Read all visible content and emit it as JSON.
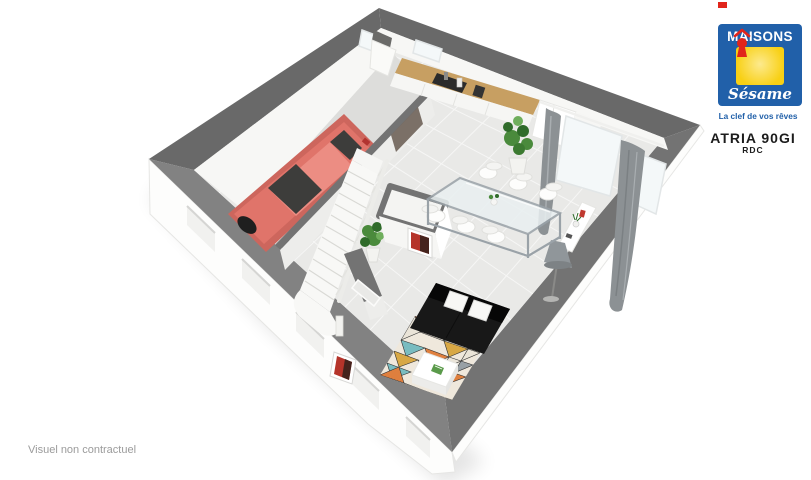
{
  "branding": {
    "maisons": "MAISONS",
    "sesame": "Sésame",
    "tagline": "La clef de vos rêves"
  },
  "plan": {
    "model": "ATRIA 90GI",
    "level": "RDC"
  },
  "footer": {
    "disclaimer": "Visuel non contractuel"
  },
  "scene": {
    "type": "3d-isometric-floor-plan",
    "elements": [
      "garage",
      "red-car",
      "staircase",
      "kitchen-counter",
      "extractor-hood",
      "tall-cabinets",
      "dining-table",
      "white-chairs",
      "bay-window",
      "gray-curtains",
      "console",
      "floor-lamp",
      "black-sofa",
      "white-pillows",
      "mosaic-rug",
      "coffee-table",
      "plants",
      "wc-block",
      "red-artwork",
      "entry-door",
      "exterior-walls"
    ]
  },
  "colors": {
    "paper": "#ffffff",
    "brandBlue": "#2160a9",
    "brandYellow": "#f8d014",
    "brandRed": "#e1251b",
    "text": "#1c1c1c",
    "disclaimer": "#9b9b9b",
    "wallTop": "#737373",
    "wallTopDark": "#696969",
    "wallTopLight": "#828282",
    "wallFace": "#f7f7f5",
    "floorTile": "#e9e9e7",
    "garageFloor": "#dddddb",
    "car": "#e0746a",
    "carDark": "#cd665d",
    "glassDark": "#3d3d3b",
    "sofa": "#181818",
    "pillow": "#f7f7f5",
    "wood": "#c79f62",
    "cooktop": "#2b2b2b",
    "curtain": "#8c9194",
    "steel": "#9aa2a8",
    "lamp": "#90969a",
    "plant": "#4a8a3c",
    "plantDark": "#2f6b2a",
    "rugBase": "#efe8dc",
    "rugOrange": "#df7f3e",
    "rugTeal": "#79bcc0",
    "rugMustard": "#d8a845",
    "rugGray": "#98a0a5",
    "artRed": "#b5342a"
  }
}
